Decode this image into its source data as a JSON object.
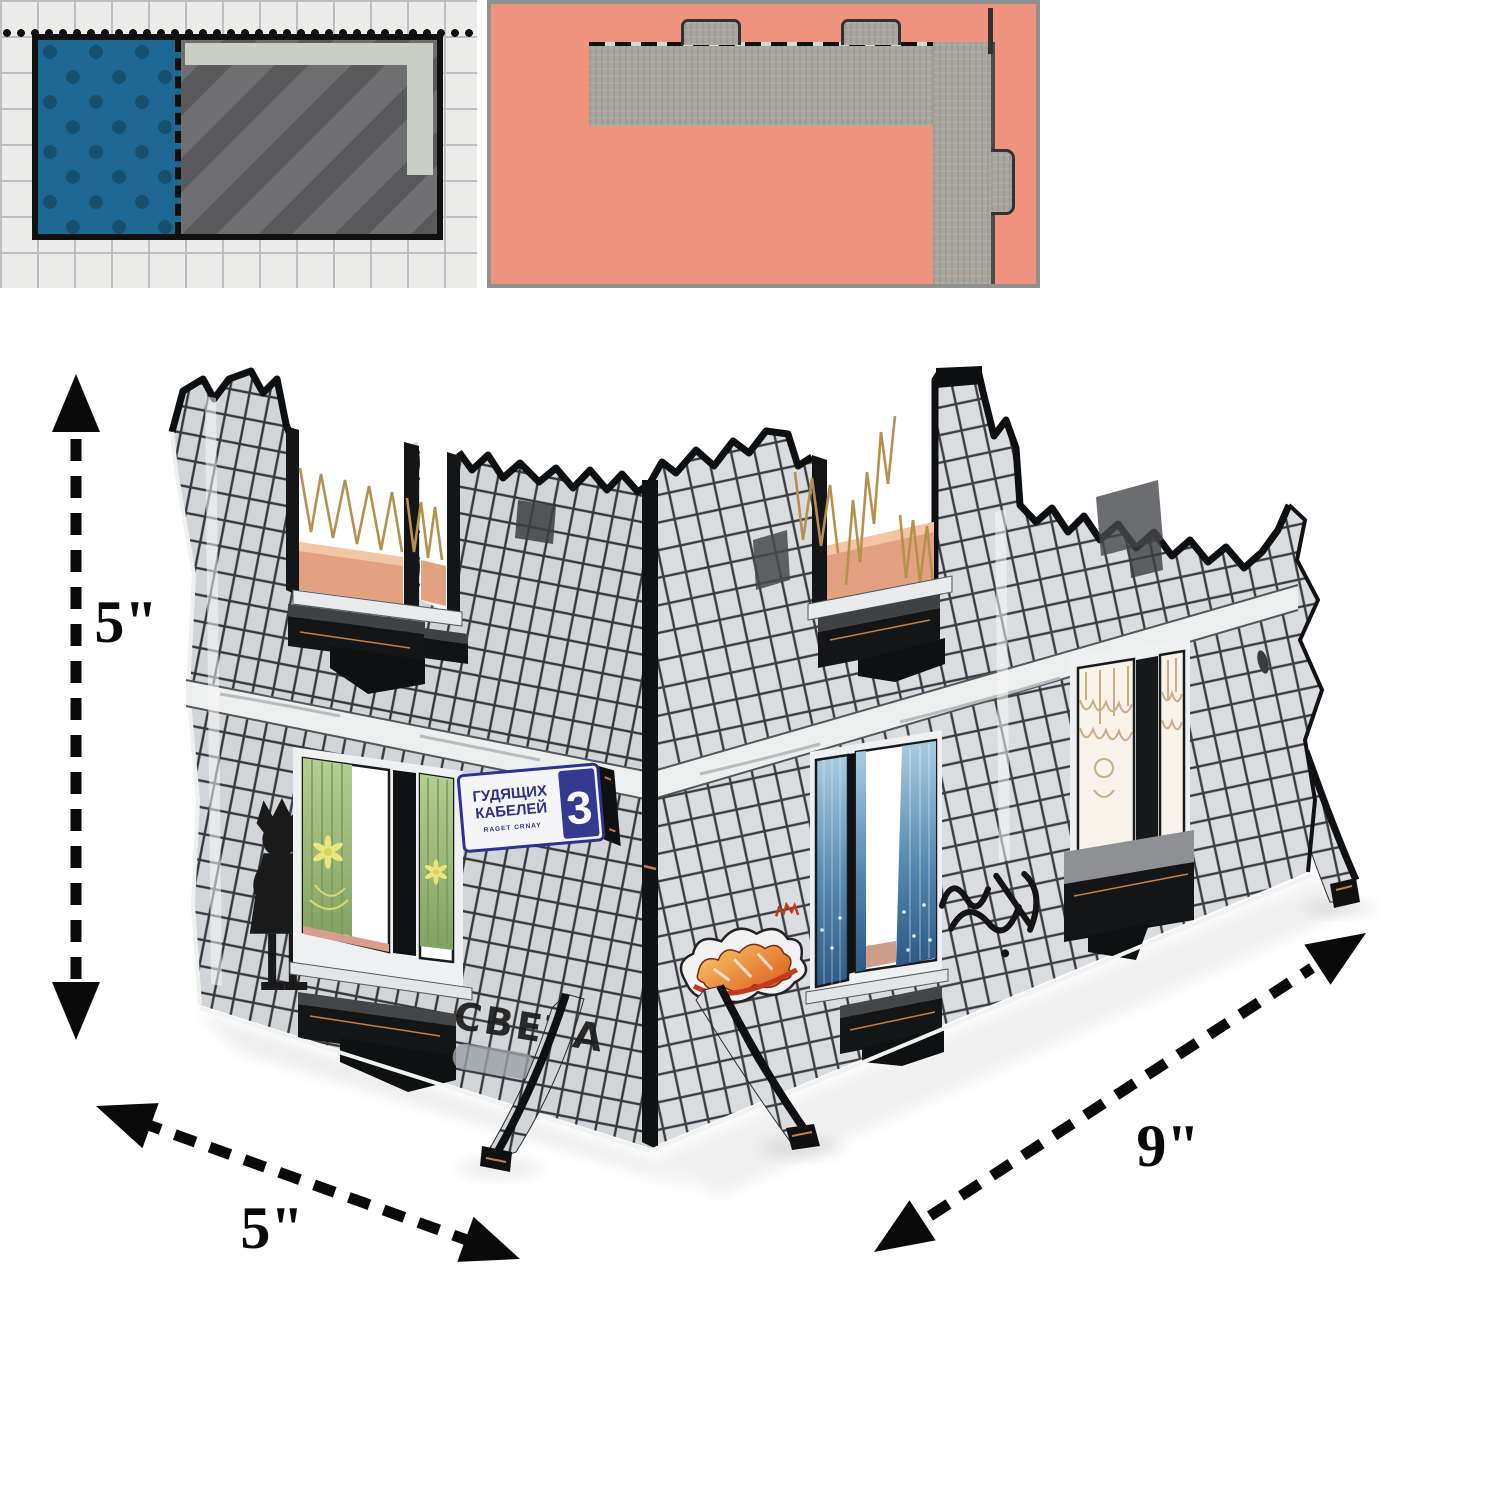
{
  "palette": {
    "page_bg": "#ffffff",
    "plan_tile_bg": "#ebece9",
    "plan_tile_line": "#bcbec0",
    "plan_blue": "#1d6793",
    "plan_blue_dot": "#16506f",
    "plan_gray": "#6f6f71",
    "plan_gray_stripe": "#5a5a5c",
    "plan_band": "#c9cfc5",
    "plan_outline": "#101010",
    "footprint_bg": "#ef937e",
    "footprint_wall": "#a7a59d",
    "footprint_border": "#8f9191",
    "wall_tile": "#d5d8da",
    "wall_tile_line": "#35383c",
    "ruin_edge": "#0e0f11",
    "floor_orange": "#e2a181",
    "band_light": "#edeeee",
    "sill_black": "#141517",
    "accent_kraft": "#c87f3f",
    "curtain_green": "#9ab873",
    "curtain_blue": "#4f83ad",
    "lace_tan": "#c9ad87",
    "sign_blue": "#32388e",
    "graffiti_orange": "#e2571f",
    "arrow_black": "#0a0a0a"
  },
  "dimensions": {
    "height": "5\"",
    "depth": "5\"",
    "length": "9\""
  },
  "street_sign": {
    "line1": "ГУДЯЩИХ",
    "line2": "КАБЕЛЕЙ",
    "subtitle": "RAGET CRNAY",
    "number": "3"
  },
  "graffiti": {
    "sveta": "СВЕТА"
  }
}
